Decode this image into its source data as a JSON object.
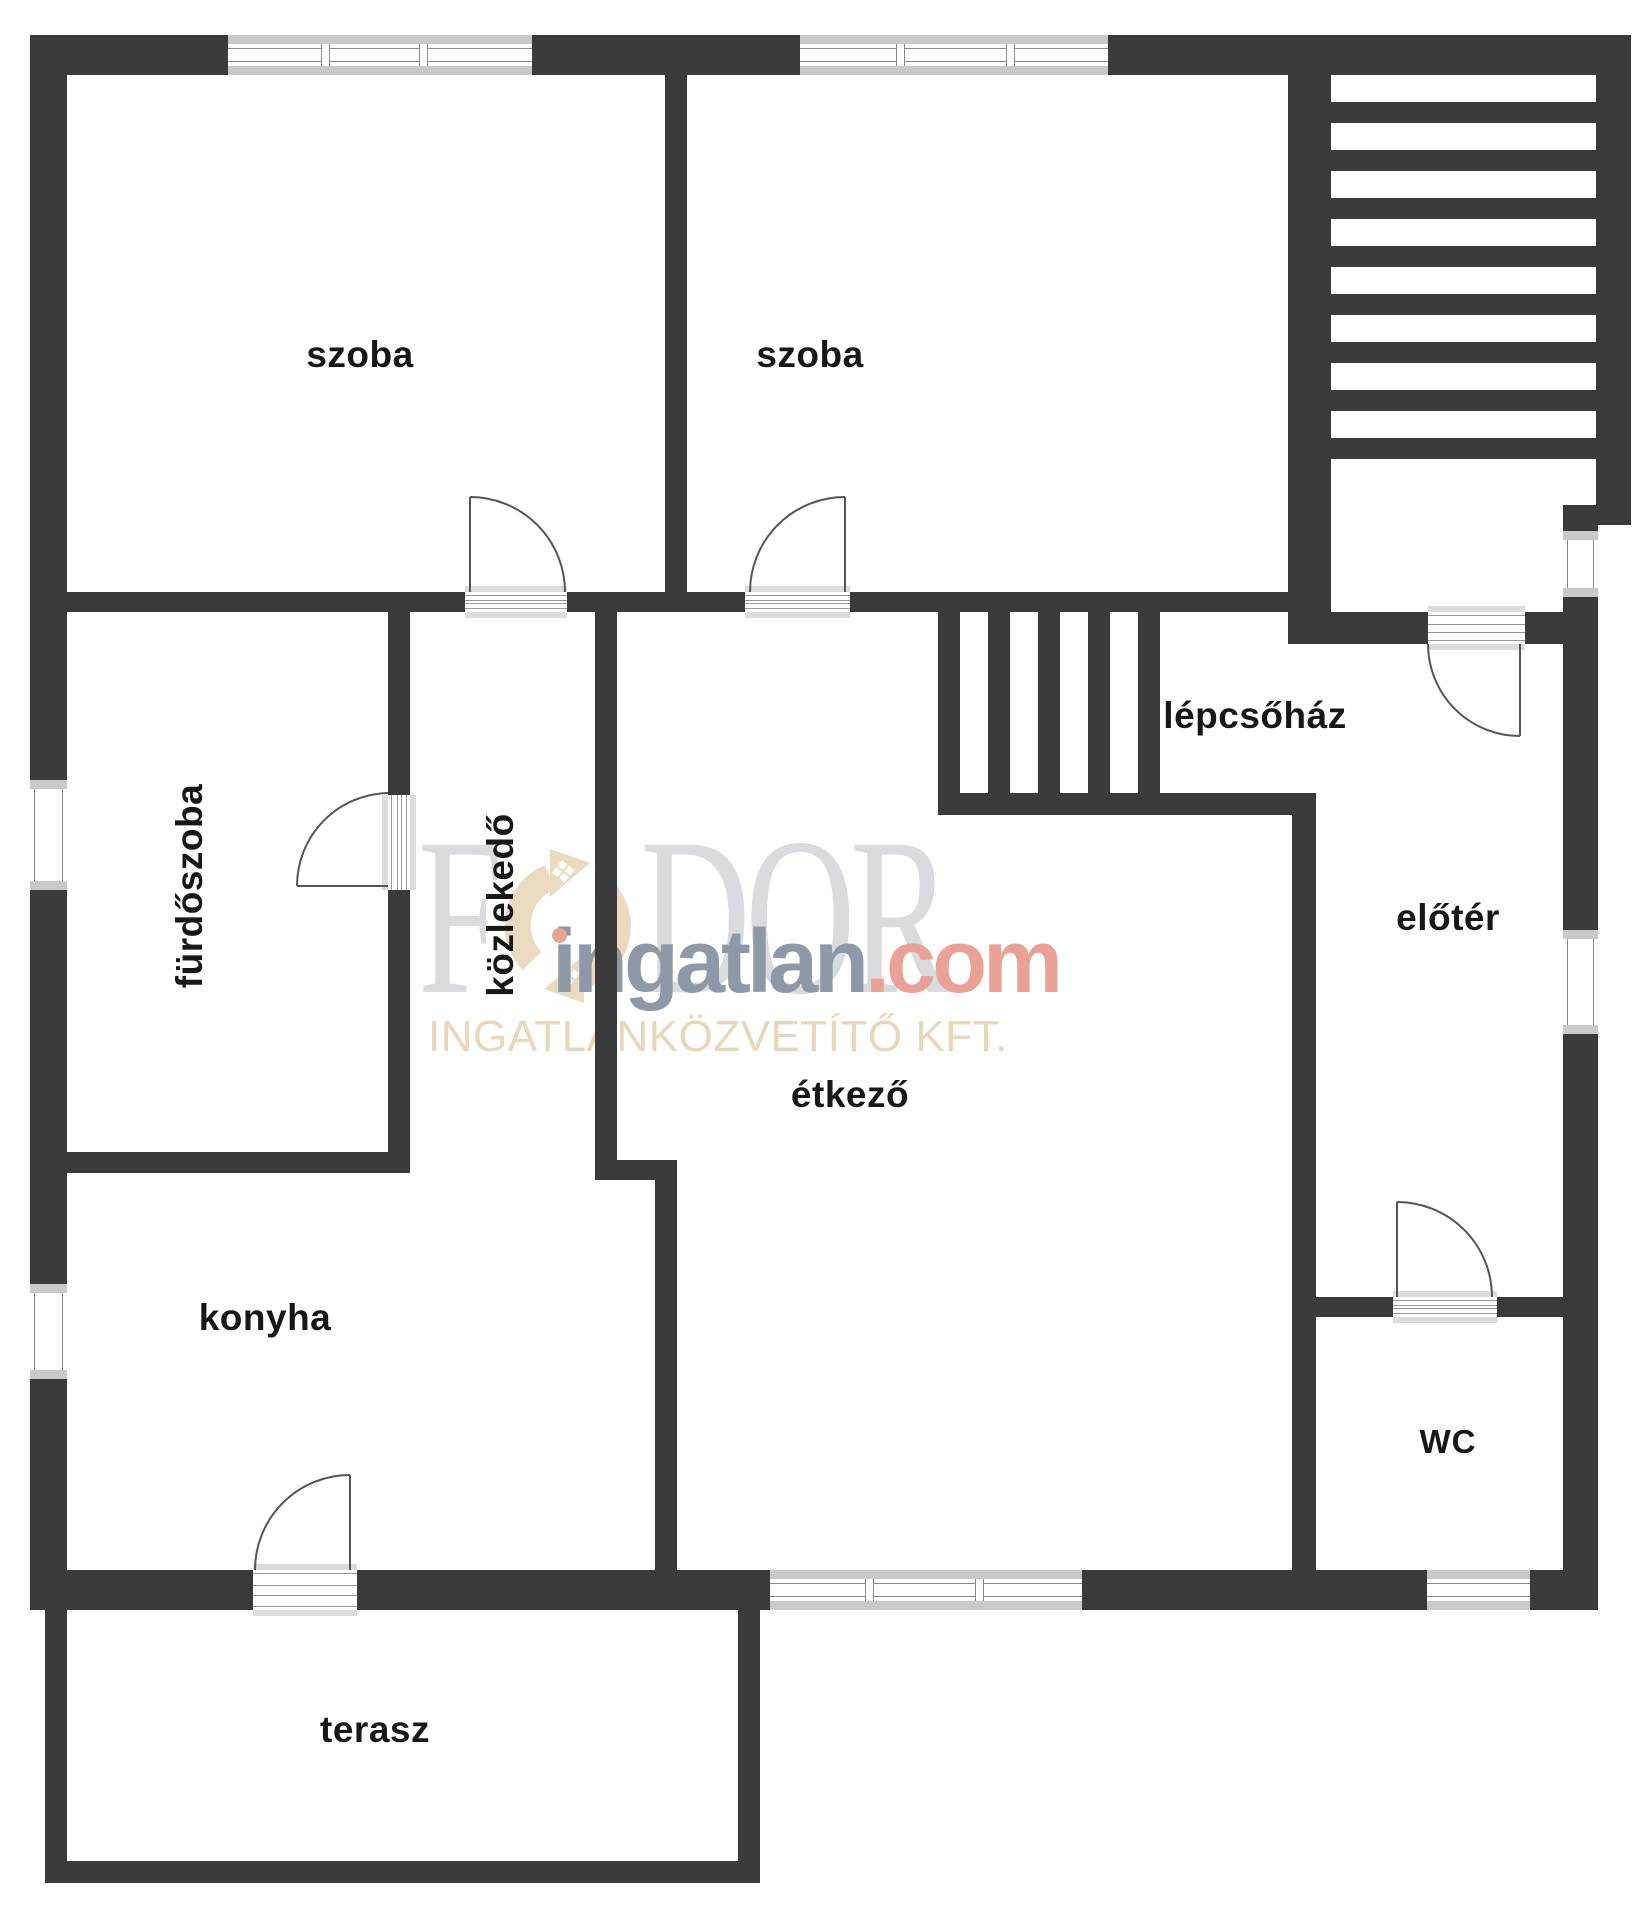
{
  "plan_type": "floor-plan",
  "rooms": [
    {
      "name": "szoba-1",
      "label": "szoba"
    },
    {
      "name": "szoba-2",
      "label": "szoba"
    },
    {
      "name": "furdoszoba",
      "label": "fürdőszoba"
    },
    {
      "name": "kozlekedo",
      "label": "közlekedő"
    },
    {
      "name": "lepcsohaz",
      "label": "lépcsőház"
    },
    {
      "name": "eloter",
      "label": "előtér"
    },
    {
      "name": "etkezo",
      "label": "étkező"
    },
    {
      "name": "konyha",
      "label": "konyha"
    },
    {
      "name": "wc",
      "label": "wc"
    },
    {
      "name": "terasz",
      "label": "terasz"
    }
  ],
  "watermark": {
    "brand_first_letter": "F",
    "brand_rest": "DOR",
    "domain_name": "ingatlan",
    "domain_tld": ".com",
    "company": "INGATLANKÖZVETÍTŐ KFT."
  },
  "colors": {
    "wall": "#3a3a3a",
    "floor": "#ffffff",
    "window_frame": "#c9c9c9",
    "door_arc": "#555555",
    "label_text": "#171717",
    "watermark_serif": "#d9dbdf",
    "watermark_domain": "#8f98a6",
    "watermark_tld": "#e9a295",
    "watermark_company": "#e9d7ba",
    "watermark_logo": "#eadbc0"
  }
}
